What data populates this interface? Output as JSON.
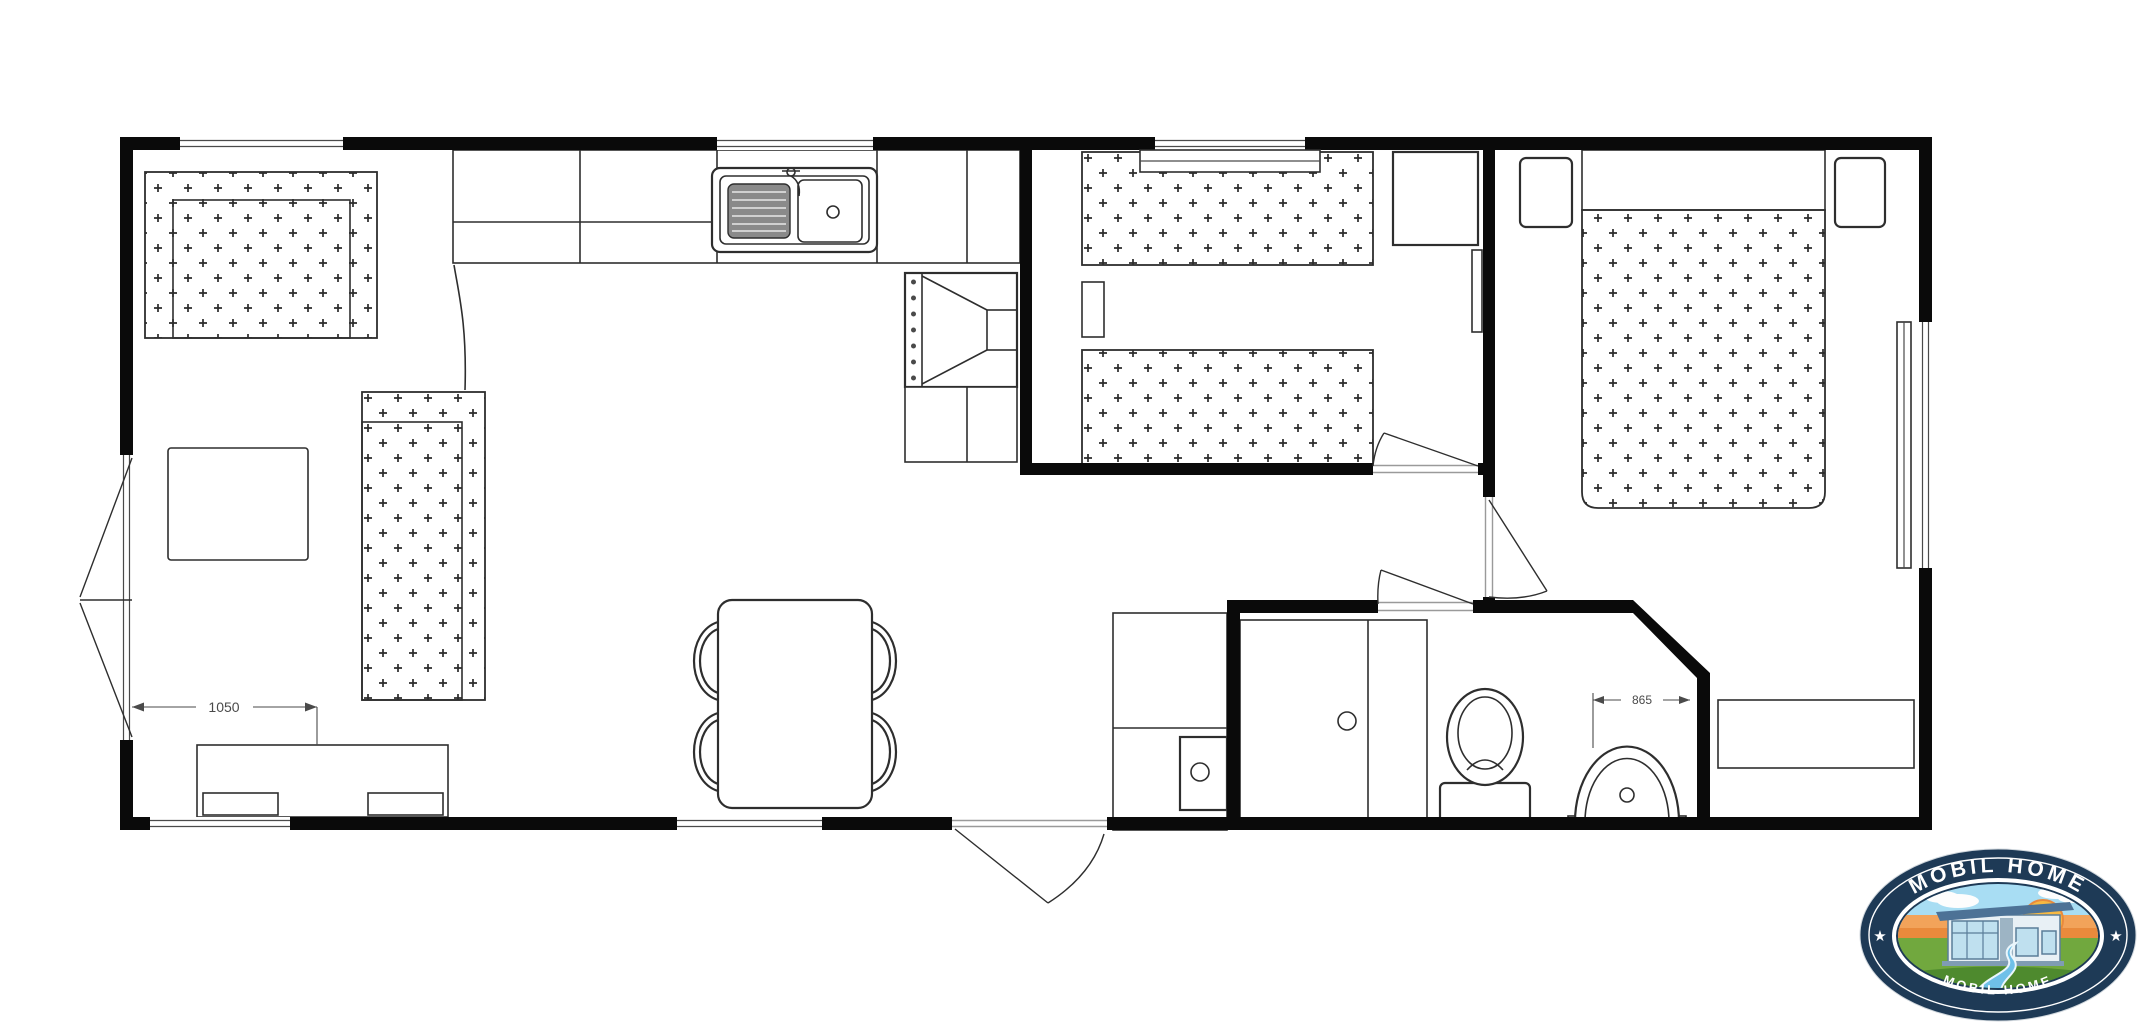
{
  "page": {
    "background": "#ffffff"
  },
  "floor_plan": {
    "dimension_labels": {
      "living_room": "1050",
      "bathroom": "865"
    },
    "colors": {
      "wall": "#0a0a0a",
      "line": "#2e2e2e",
      "background": "#ffffff",
      "upholstery_mark": "#2b2b2b"
    }
  },
  "logo": {
    "text_top": "MOBIL HOME",
    "text_bottom": "MOBIL HOME",
    "star_glyph": "★",
    "colors": {
      "ring_navy": "#1e3a56",
      "text": "#ffffff",
      "sky": "#a8ddf3",
      "sunset_orange": "#f2a35a",
      "sunset_deep": "#e98a3c",
      "sun": "#f7b942",
      "grass": "#71a83e",
      "grass_dark": "#4e8a2e",
      "river": "#6fc0e8",
      "house_wall": "#e8f0f5",
      "house_roof": "#4d7296",
      "window_glass": "#bfe0ef",
      "cloud": "#fdfdfd"
    }
  }
}
